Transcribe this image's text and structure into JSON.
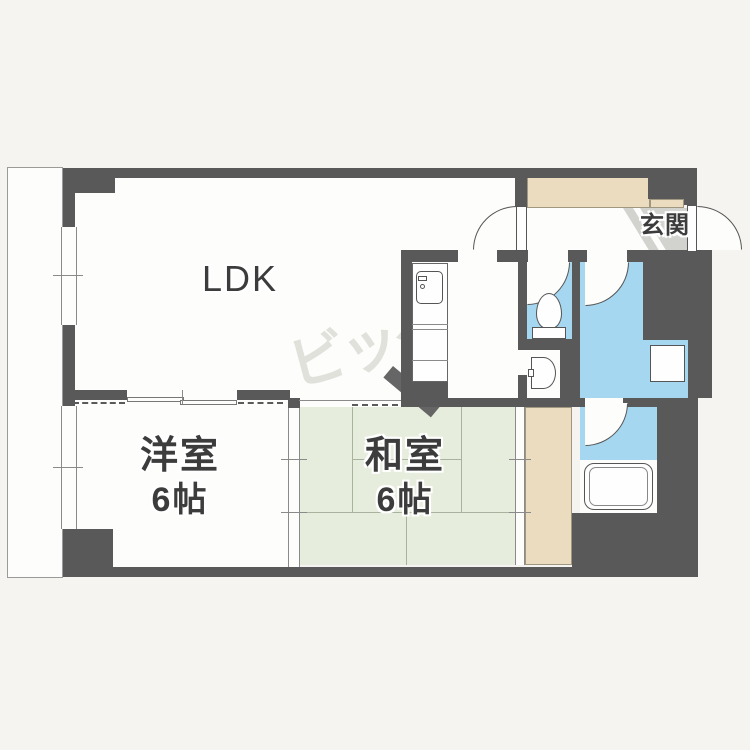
{
  "plan": {
    "rooms": {
      "ldk": {
        "label": "LDK"
      },
      "western_room": {
        "label": "洋室",
        "area": "6帖"
      },
      "japanese_room": {
        "label": "和室",
        "area": "6帖"
      },
      "entrance": {
        "label": "玄関"
      }
    },
    "watermark": "ビッグ",
    "colors": {
      "wall": "#595959",
      "tatami_room": "#e7eddd",
      "wet_area": "#a6d7f0",
      "closet": "#ecdcbf",
      "genkan_floor": "#d2d2cf",
      "background": "#f5f4f1"
    },
    "fixtures": [
      "kitchen-sink",
      "toilet",
      "washbasin",
      "washing-machine-pan",
      "bathtub"
    ]
  }
}
